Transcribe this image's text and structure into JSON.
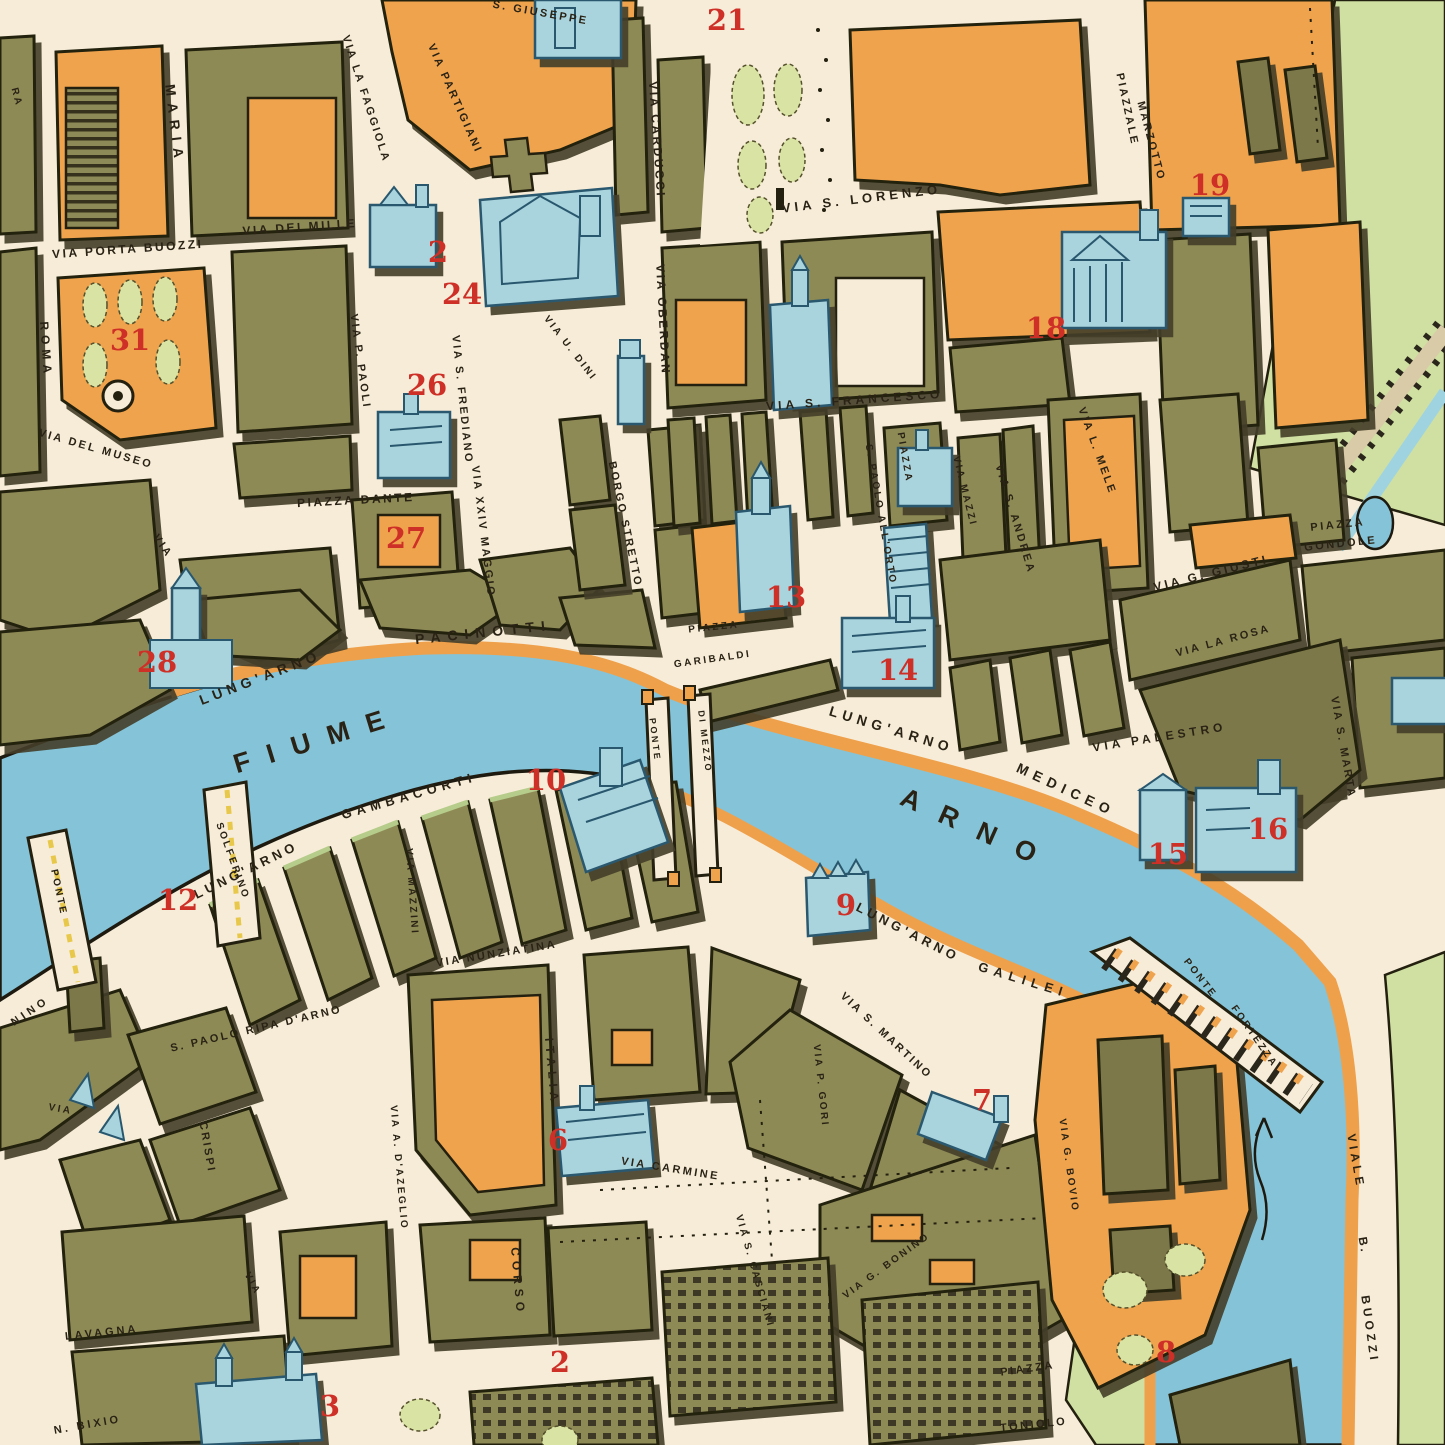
{
  "map": {
    "city": "Pisa",
    "type": "vintage-pictorial-street-map",
    "colors": {
      "paper": "#f7ecd8",
      "block_olive": "#8e8a57",
      "block_orange": "#f0a34d",
      "water_blue": "#85c3d8",
      "landmark_blue": "#a9d3dd",
      "park_green": "#cfe0a2",
      "bank_road_orange": "#efa04b",
      "ink": "#2a2315",
      "number_red": "#ce2f27"
    },
    "river_name": "FIUME ARNO"
  },
  "street_labels": [
    {
      "t": "MARIA",
      "x": 170,
      "y": 125,
      "r": 83,
      "s": 14,
      "sp": 7
    },
    {
      "t": "VIA PORTA BUOZZI",
      "x": 128,
      "y": 253,
      "r": -4,
      "s": 12
    },
    {
      "t": "VIA DEI MILLE",
      "x": 300,
      "y": 231,
      "r": -4,
      "s": 12
    },
    {
      "t": "VIA LA FAGGIOLA",
      "x": 363,
      "y": 100,
      "r": 72,
      "s": 11
    },
    {
      "t": "VIA PARTIGIANI",
      "x": 452,
      "y": 100,
      "r": 66,
      "s": 11
    },
    {
      "t": "S. GIUSEPPE",
      "x": 540,
      "y": 16,
      "r": 10,
      "s": 11
    },
    {
      "t": "VIA CARDUCCI",
      "x": 653,
      "y": 140,
      "r": 86,
      "s": 12
    },
    {
      "t": "VIA OBERDAN",
      "x": 659,
      "y": 320,
      "r": 87,
      "s": 12
    },
    {
      "t": "VIA S. LORENZO",
      "x": 862,
      "y": 203,
      "r": -7,
      "s": 13,
      "sp": 4
    },
    {
      "t": "PIAZZALE",
      "x": 1124,
      "y": 110,
      "r": 78,
      "s": 11
    },
    {
      "t": "MARZOTTO",
      "x": 1148,
      "y": 142,
      "r": 75,
      "s": 11
    },
    {
      "t": "VIA S. FRANCESCO",
      "x": 855,
      "y": 404,
      "r": -4,
      "s": 12,
      "sp": 4
    },
    {
      "t": "VIA P. PAOLI",
      "x": 357,
      "y": 362,
      "r": 82,
      "s": 11
    },
    {
      "t": "VIA S. FREDIANO",
      "x": 459,
      "y": 400,
      "r": 84,
      "s": 11
    },
    {
      "t": "ROMA",
      "x": 42,
      "y": 350,
      "r": 86,
      "s": 12,
      "sp": 5
    },
    {
      "t": "VIA DEL MUSEO",
      "x": 95,
      "y": 452,
      "r": 16,
      "s": 11
    },
    {
      "t": "VIA",
      "x": 160,
      "y": 548,
      "r": 55,
      "s": 11
    },
    {
      "t": "PIAZZA DANTE",
      "x": 356,
      "y": 504,
      "r": -3,
      "s": 12
    },
    {
      "t": "VIA XXIV MAGGIO",
      "x": 480,
      "y": 532,
      "r": 83,
      "s": 11
    },
    {
      "t": "VIA U. DINI",
      "x": 568,
      "y": 350,
      "r": 52,
      "s": 10
    },
    {
      "t": "BORGO STRETTO",
      "x": 622,
      "y": 525,
      "r": 78,
      "s": 11
    },
    {
      "t": "PIAZZA",
      "x": 902,
      "y": 458,
      "r": 80,
      "s": 10
    },
    {
      "t": "S. PAOLO ALL'ORTO",
      "x": 878,
      "y": 515,
      "r": 80,
      "s": 10
    },
    {
      "t": "VIA PALESTRO",
      "x": 1160,
      "y": 741,
      "r": -9,
      "s": 12,
      "sp": 4
    },
    {
      "t": "VIA MAZZI",
      "x": 962,
      "y": 492,
      "r": 76,
      "s": 10
    },
    {
      "t": "VIA S. ANDREA",
      "x": 1012,
      "y": 520,
      "r": 73,
      "s": 11
    },
    {
      "t": "VIA L. MELE",
      "x": 1094,
      "y": 452,
      "r": 70,
      "s": 11
    },
    {
      "t": "VIA G. GIUSTI",
      "x": 1212,
      "y": 577,
      "r": -14,
      "s": 12,
      "sp": 3
    },
    {
      "t": "PIAZZA",
      "x": 1338,
      "y": 528,
      "r": -6,
      "s": 11
    },
    {
      "t": "GONDOLE",
      "x": 1341,
      "y": 547,
      "r": -6,
      "s": 11
    },
    {
      "t": "VIA LA ROSA",
      "x": 1224,
      "y": 644,
      "r": -15,
      "s": 11
    },
    {
      "t": "VIA S. MARTA",
      "x": 1340,
      "y": 748,
      "r": 80,
      "s": 11
    },
    {
      "t": "LUNG'ARNO",
      "x": 262,
      "y": 682,
      "r": -21,
      "s": 14,
      "sp": 5
    },
    {
      "t": "PACINOTTI",
      "x": 484,
      "y": 637,
      "r": -6,
      "s": 14,
      "sp": 7
    },
    {
      "t": "LUNG'ARNO",
      "x": 890,
      "y": 734,
      "r": 17,
      "s": 14,
      "sp": 5
    },
    {
      "t": "MEDICEO",
      "x": 1064,
      "y": 794,
      "r": 25,
      "s": 14,
      "sp": 6
    },
    {
      "t": "FIUME",
      "x": 320,
      "y": 748,
      "r": -17,
      "s": 27,
      "sp": 18
    },
    {
      "t": "ARNO",
      "x": 975,
      "y": 838,
      "r": 24,
      "s": 27,
      "sp": 22
    },
    {
      "t": "PIAZZA",
      "x": 714,
      "y": 630,
      "r": -6,
      "s": 10
    },
    {
      "t": "GARIBALDI",
      "x": 713,
      "y": 662,
      "r": -8,
      "s": 10
    },
    {
      "t": "PONTE",
      "x": 652,
      "y": 740,
      "r": 83,
      "s": 9
    },
    {
      "t": "DI MEZZO",
      "x": 702,
      "y": 742,
      "r": 83,
      "s": 9
    },
    {
      "t": "LUNG'ARNO",
      "x": 248,
      "y": 874,
      "r": -26,
      "s": 13,
      "sp": 4
    },
    {
      "t": "GAMBACORTI",
      "x": 410,
      "y": 800,
      "r": -16,
      "s": 13,
      "sp": 5
    },
    {
      "t": "SOLFERINO",
      "x": 230,
      "y": 862,
      "r": 70,
      "s": 10
    },
    {
      "t": "PONTE",
      "x": 56,
      "y": 893,
      "r": 78,
      "s": 10
    },
    {
      "t": "NINO",
      "x": 32,
      "y": 1014,
      "r": -34,
      "s": 11,
      "sp": 4
    },
    {
      "t": "LUNG'ARNO",
      "x": 906,
      "y": 936,
      "r": 27,
      "s": 13,
      "sp": 4
    },
    {
      "t": "GALILEI",
      "x": 1022,
      "y": 984,
      "r": 17,
      "s": 13,
      "sp": 6
    },
    {
      "t": "VIA S. MARTINO",
      "x": 884,
      "y": 1038,
      "r": 43,
      "s": 11
    },
    {
      "t": "VIA MAZZINI",
      "x": 409,
      "y": 892,
      "r": 86,
      "s": 10
    },
    {
      "t": "VIA NUNZIATINA",
      "x": 497,
      "y": 957,
      "r": -9,
      "s": 11
    },
    {
      "t": "S. PAOLO RIPA D'ARNO",
      "x": 257,
      "y": 1032,
      "r": -13,
      "s": 11
    },
    {
      "t": "VIA",
      "x": 60,
      "y": 1112,
      "r": 10,
      "s": 10
    },
    {
      "t": "CRISPI",
      "x": 204,
      "y": 1148,
      "r": 80,
      "s": 11
    },
    {
      "t": "VIA A. D'AZEGLIO",
      "x": 396,
      "y": 1168,
      "r": 85,
      "s": 10
    },
    {
      "t": "ITALIA",
      "x": 548,
      "y": 1072,
      "r": 85,
      "s": 12,
      "sp": 5
    },
    {
      "t": "CORSO",
      "x": 514,
      "y": 1282,
      "r": 85,
      "s": 12,
      "sp": 5
    },
    {
      "t": "VIA CARMINE",
      "x": 670,
      "y": 1172,
      "r": 9,
      "s": 11
    },
    {
      "t": "VIA P. GORI",
      "x": 818,
      "y": 1086,
      "r": 84,
      "s": 10
    },
    {
      "t": "VIA S. CASCIANI",
      "x": 752,
      "y": 1272,
      "r": 74,
      "s": 10
    },
    {
      "t": "VIA G. BONINO",
      "x": 888,
      "y": 1268,
      "r": -36,
      "s": 10
    },
    {
      "t": "VIA G. BOVIO",
      "x": 1066,
      "y": 1166,
      "r": 82,
      "s": 10
    },
    {
      "t": "PIAZZA",
      "x": 1028,
      "y": 1372,
      "r": -8,
      "s": 11
    },
    {
      "t": "TONIOLO",
      "x": 1034,
      "y": 1428,
      "r": -6,
      "s": 11
    },
    {
      "t": "PONTE",
      "x": 1198,
      "y": 980,
      "r": 52,
      "s": 10
    },
    {
      "t": "FORTEZZA",
      "x": 1252,
      "y": 1038,
      "r": 55,
      "s": 10
    },
    {
      "t": "VIALE",
      "x": 1352,
      "y": 1162,
      "r": 80,
      "s": 12,
      "sp": 4
    },
    {
      "t": "B.",
      "x": 1360,
      "y": 1246,
      "r": 80,
      "s": 12
    },
    {
      "t": "BUOZZI",
      "x": 1366,
      "y": 1330,
      "r": 82,
      "s": 12,
      "sp": 4
    },
    {
      "t": "LAVAGNA",
      "x": 102,
      "y": 1336,
      "r": -6,
      "s": 11,
      "sp": 3
    },
    {
      "t": "N. BIXIO",
      "x": 88,
      "y": 1428,
      "r": -10,
      "s": 11,
      "sp": 3
    },
    {
      "t": "VIA",
      "x": 250,
      "y": 1285,
      "r": 62,
      "s": 10
    },
    {
      "t": "RA",
      "x": 14,
      "y": 98,
      "r": 75,
      "s": 10
    }
  ],
  "landmark_numbers": [
    {
      "n": "21",
      "x": 727,
      "y": 30
    },
    {
      "n": "2",
      "x": 438,
      "y": 262
    },
    {
      "n": "24",
      "x": 462,
      "y": 304
    },
    {
      "n": "26",
      "x": 427,
      "y": 395
    },
    {
      "n": "31",
      "x": 130,
      "y": 350
    },
    {
      "n": "18",
      "x": 1046,
      "y": 338
    },
    {
      "n": "19",
      "x": 1210,
      "y": 195
    },
    {
      "n": "27",
      "x": 406,
      "y": 548
    },
    {
      "n": "13",
      "x": 786,
      "y": 607
    },
    {
      "n": "14",
      "x": 898,
      "y": 680
    },
    {
      "n": "28",
      "x": 157,
      "y": 672
    },
    {
      "n": "12",
      "x": 178,
      "y": 910
    },
    {
      "n": "10",
      "x": 546,
      "y": 790
    },
    {
      "n": "9",
      "x": 846,
      "y": 915
    },
    {
      "n": "15",
      "x": 1168,
      "y": 864
    },
    {
      "n": "16",
      "x": 1268,
      "y": 839
    },
    {
      "n": "7",
      "x": 982,
      "y": 1110
    },
    {
      "n": "6",
      "x": 558,
      "y": 1150
    },
    {
      "n": "8",
      "x": 1166,
      "y": 1362
    },
    {
      "n": "2",
      "x": 560,
      "y": 1372
    },
    {
      "n": "3",
      "x": 330,
      "y": 1416
    }
  ]
}
